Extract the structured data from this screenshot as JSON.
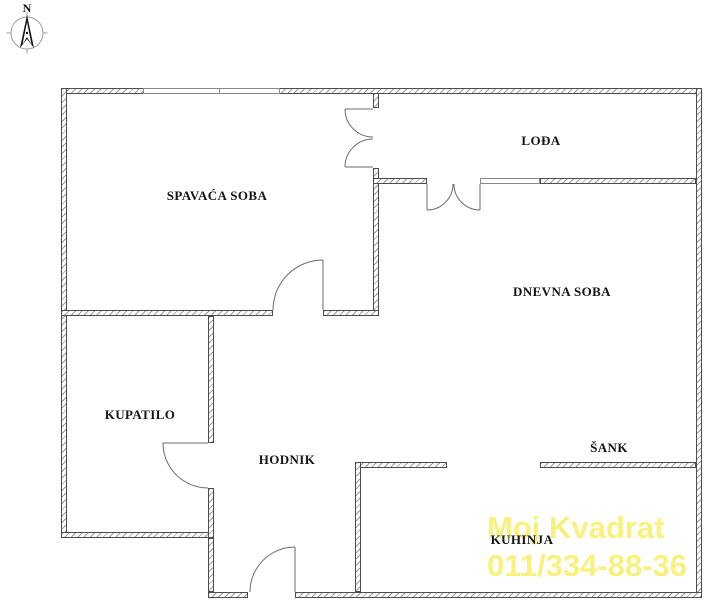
{
  "compass": {
    "north_label": "N"
  },
  "rooms": [
    {
      "id": "spavaca-soba",
      "label": "SPAVAĆA SOBA"
    },
    {
      "id": "lodja",
      "label": "LOĐA"
    },
    {
      "id": "dnevna-soba",
      "label": "DNEVNA SOBA"
    },
    {
      "id": "kupatilo",
      "label": "KUPATILO"
    },
    {
      "id": "hodnik",
      "label": "HODNIK"
    },
    {
      "id": "sank",
      "label": "ŠANK"
    },
    {
      "id": "kuhinja",
      "label": "KUHINJA"
    }
  ],
  "watermark": {
    "line1": "Moj Kvadrat",
    "line2": "011/334-88-36",
    "color": "#f8f17d"
  },
  "plan_style": {
    "wall_hatch_color": "#9b9b9b",
    "wall_edge_color": "#4d4d4d",
    "door_line_color": "#6b6b6b",
    "label_color": "#151515"
  }
}
